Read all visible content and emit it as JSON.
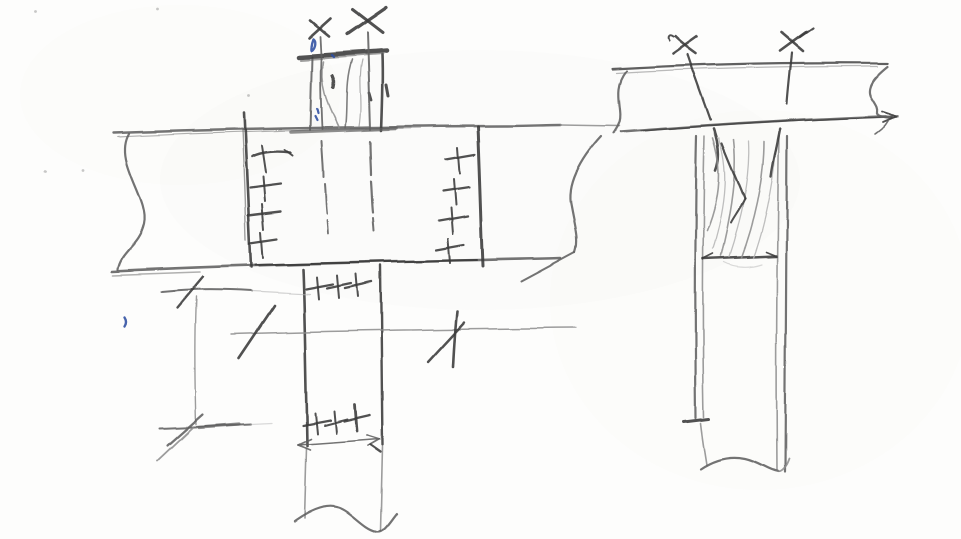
{
  "meta": {
    "kind": "hand-drawn pencil sketch",
    "subject": "timber beam-to-post connection details with screw markers, fastener crosses, wood grain and dimension ticks",
    "paper_color": "#fdfdfc"
  },
  "palette": {
    "k": "#3a3a3a",
    "m": "#606060",
    "l": "#8e8e8e",
    "f": "#b5b5b5",
    "b": "#2d4fa1"
  },
  "sketch": {
    "elements": [
      {
        "name": "left-beam",
        "label": "left detail continuous beam (side view) with break lines",
        "strokes": [
          {
            "d": "M114,133 C 230,129 400,126 505,126 C 525,126 548,125 561,125",
            "c": "m",
            "w": 2.4
          },
          {
            "d": "M118,137 C 200,133 300,130 420,128",
            "c": "l",
            "w": 1.2,
            "o": 0.7
          },
          {
            "d": "M561,125 L 619,126",
            "c": "l",
            "w": 1.4
          },
          {
            "d": "M112,271 C 220,266 360,262 480,260 C 510,259 540,259 561,258",
            "c": "m",
            "w": 2.6
          },
          {
            "d": "M255,265 C 330,263 410,261 477,260",
            "c": "k",
            "w": 2
          },
          {
            "d": "M113,275 L 200,272",
            "c": "l",
            "w": 1.6,
            "o": 0.7
          },
          {
            "d": "M129,134 C 113,162 150,198 144,224 C 139,246 121,251 118,269",
            "c": "m",
            "w": 2.2
          },
          {
            "d": "M601,136 C 579,160 566,186 571,206 C 575,228 579,240 575,252",
            "c": "m",
            "w": 2.2
          },
          {
            "d": "M575,252 L 521,281",
            "c": "m",
            "w": 2
          }
        ]
      },
      {
        "name": "left-joint-line-left",
        "label": "left vertical joint line of connection zone",
        "strokes": [
          {
            "d": "M244,113 C 246,160 248,210 251,267",
            "c": "k",
            "w": 2.6
          },
          {
            "d": "M242,130 C 244,170 245,205 246,240",
            "c": "m",
            "w": 1.4,
            "o": 0.6
          }
        ]
      },
      {
        "name": "left-joint-line-right",
        "label": "right vertical joint line of connection zone",
        "strokes": [
          {
            "d": "M478,127 C 480,170 481,215 483,266",
            "c": "k",
            "w": 3
          }
        ]
      },
      {
        "name": "fastener-column-left",
        "label": "column of 4 fastener cross marks",
        "strokes": [
          {
            "d": "M252,157 C 262,152 278,151 291,153",
            "c": "k",
            "w": 2.4
          },
          {
            "d": "M262,146 L 266,173",
            "c": "k",
            "w": 2
          },
          {
            "d": "M285,150 L 293,156",
            "c": "k",
            "w": 2
          },
          {
            "d": "M250,188 L 281,184",
            "c": "k",
            "w": 2.2
          },
          {
            "d": "M263,177 L 265,201",
            "c": "k",
            "w": 2
          },
          {
            "d": "M248,215 L 281,211",
            "c": "k",
            "w": 2.4
          },
          {
            "d": "M262,204 L 264,229",
            "c": "k",
            "w": 2
          },
          {
            "d": "M250,243 L 277,239",
            "c": "k",
            "w": 2.2
          },
          {
            "d": "M261,232 L 263,258",
            "c": "k",
            "w": 2
          }
        ]
      },
      {
        "name": "fastener-column-right",
        "label": "column of 4 fastener cross marks",
        "strokes": [
          {
            "d": "M446,159 L 475,154",
            "c": "k",
            "w": 2.4
          },
          {
            "d": "M458,147 L 460,173",
            "c": "k",
            "w": 2
          },
          {
            "d": "M443,191 L 470,187",
            "c": "k",
            "w": 2.2
          },
          {
            "d": "M454,179 L 456,205",
            "c": "k",
            "w": 2
          },
          {
            "d": "M439,221 L 468,216",
            "c": "k",
            "w": 2.4
          },
          {
            "d": "M451,208 L 453,234",
            "c": "k",
            "w": 2
          },
          {
            "d": "M436,250 L 464,245",
            "c": "k",
            "w": 2.2
          },
          {
            "d": "M448,239 L 450,263",
            "c": "k",
            "w": 2
          }
        ]
      },
      {
        "name": "top-post-stub",
        "label": "post stub above beam with cap plate and wood grain",
        "strokes": [
          {
            "d": "M312,57 L 310,130",
            "c": "m",
            "w": 2
          },
          {
            "d": "M382,55 C 383,80 382,105 381,130",
            "c": "k",
            "w": 2.6
          },
          {
            "d": "M299,57 L 387,51",
            "c": "k",
            "w": 4.5
          },
          {
            "d": "M301,60 L 383,54",
            "c": "m",
            "w": 2,
            "o": 0.6
          },
          {
            "d": "M292,132 L 396,128",
            "c": "m",
            "w": 3.5,
            "o": 0.7
          },
          {
            "d": "M323,62 C 318,88 330,108 339,128",
            "c": "l",
            "w": 1.6
          },
          {
            "d": "M352,60 C 344,84 348,108 345,128",
            "c": "m",
            "w": 1.6,
            "o": 0.8
          },
          {
            "d": "M362,60 C 357,80 363,102 359,126",
            "c": "l",
            "w": 1.2,
            "o": 0.7
          },
          {
            "d": "M332,76 C 334,80 334,84 333,88",
            "c": "k",
            "w": 3.2
          },
          {
            "d": "M369,93 L 371,100",
            "c": "k",
            "w": 2.8
          },
          {
            "d": "M386,85 L 388,96",
            "c": "k",
            "w": 3
          },
          {
            "d": "M320,37 L 321,56 M321,58 C 320,84 321,108 322,129",
            "c": "m",
            "w": 1.8
          },
          {
            "d": "M367,33 C 368,64 369,98 370,129",
            "c": "m",
            "w": 2
          }
        ]
      },
      {
        "name": "top-post-screw-x-marks",
        "label": "two X screw-head marks above stub",
        "strokes": [
          {
            "d": "M309,38 L 330,19",
            "c": "k",
            "w": 2.6
          },
          {
            "d": "M310,21 L 329,37",
            "c": "k",
            "w": 2.6
          },
          {
            "d": "M347,35 L 386,8",
            "c": "k",
            "w": 3.2
          },
          {
            "d": "M352,10 L 382,33",
            "c": "k",
            "w": 3
          }
        ]
      },
      {
        "name": "hidden-screw-lines",
        "label": "hidden screw shafts inside beam below stub",
        "strokes": [
          {
            "d": "M322,141 C 323,158 324,170 324,177",
            "c": "m",
            "w": 2
          },
          {
            "d": "M325,184 C 326,196 326,206 327,214",
            "c": "m",
            "w": 2
          },
          {
            "d": "M327,220 L 328,233",
            "c": "m",
            "w": 1.8
          },
          {
            "d": "M370,141 C 370,155 371,166 371,174",
            "c": "m",
            "w": 2.2
          },
          {
            "d": "M371,181 C 372,194 372,204 373,212",
            "c": "m",
            "w": 2.2
          },
          {
            "d": "M373,218 L 374,231",
            "c": "m",
            "w": 2
          }
        ]
      },
      {
        "name": "blue-ink-marks",
        "label": "small blue ballpoint dots and ticks",
        "strokes": [
          {
            "d": "M313,39 C 316,41 315,47 312,50 C 310,52 311,44 313,39",
            "c": "b",
            "w": 2.4
          },
          {
            "d": "M332,55 L 334,57",
            "c": "b",
            "w": 2.4
          },
          {
            "d": "M317,109 L 318,113",
            "c": "b",
            "w": 2.2
          },
          {
            "d": "M315,116 L 317,120",
            "c": "b",
            "w": 2.2
          },
          {
            "d": "M124,318 C 126,321 126,324 124,327",
            "c": "b",
            "w": 2.4
          }
        ]
      },
      {
        "name": "lower-post",
        "label": "post below beam continuing to break line",
        "strokes": [
          {
            "d": "M303,269 C 305,320 306,390 307,446",
            "c": "k",
            "w": 2.6
          },
          {
            "d": "M381,266 C 382,320 382,390 383,445",
            "c": "k",
            "w": 2.4
          },
          {
            "d": "M306,448 L 304,519",
            "c": "l",
            "w": 1.6
          },
          {
            "d": "M383,447 L 381,531",
            "c": "l",
            "w": 1.6
          },
          {
            "d": "M294,522 C 312,509 327,504 339,508 C 352,512 363,529 377,532 C 385,533 391,521 397,514",
            "c": "m",
            "w": 2.2
          }
        ]
      },
      {
        "name": "lower-post-fastener-row-top",
        "label": "row of 3 fastener crosses at post top",
        "strokes": [
          {
            "d": "M306,289 L 333,284",
            "c": "k",
            "w": 2.2
          },
          {
            "d": "M317,277 L 319,299",
            "c": "k",
            "w": 2
          },
          {
            "d": "M327,288 L 351,283",
            "c": "k",
            "w": 2.2
          },
          {
            "d": "M337,275 L 339,298",
            "c": "k",
            "w": 2
          },
          {
            "d": "M345,288 L 372,282",
            "c": "k",
            "w": 2.4
          },
          {
            "d": "M356,274 L 358,297",
            "c": "k",
            "w": 2
          }
        ]
      },
      {
        "name": "lower-post-fastener-row-bottom",
        "label": "row of 3 fastener crosses at post bottom",
        "strokes": [
          {
            "d": "M303,425 L 330,420",
            "c": "k",
            "w": 2.2
          },
          {
            "d": "M315,413 L 317,434",
            "c": "k",
            "w": 2
          },
          {
            "d": "M324,425 L 347,419",
            "c": "k",
            "w": 2
          },
          {
            "d": "M334,411 L 336,433",
            "c": "k",
            "w": 2
          },
          {
            "d": "M344,421 L 370,415",
            "c": "k",
            "w": 2.4
          },
          {
            "d": "M355,405 L 357,431",
            "c": "k",
            "w": 2.8
          }
        ]
      },
      {
        "name": "mid-dimension-line",
        "label": "horizontal reference line with oblique ticks",
        "strokes": [
          {
            "d": "M231,334 C 330,331 450,329 576,328",
            "c": "l",
            "w": 1.5
          },
          {
            "d": "M239,358 L 274,306",
            "c": "k",
            "w": 2.6
          },
          {
            "d": "M457,312 C 455,330 454,348 453,367",
            "c": "k",
            "w": 2.6
          },
          {
            "d": "M428,362 L 464,323",
            "c": "k",
            "w": 2.4
          }
        ]
      },
      {
        "name": "lower-post-dimension-arrow",
        "label": "width dimension arrow at post bottom",
        "strokes": [
          {
            "d": "M298,445 L 380,439",
            "c": "m",
            "w": 1.6
          },
          {
            "d": "M298,445 L 311,439",
            "c": "m",
            "w": 1.6
          },
          {
            "d": "M298,445 L 310,450",
            "c": "m",
            "w": 1.6
          },
          {
            "d": "M380,439 L 367,435",
            "c": "m",
            "w": 1.8
          },
          {
            "d": "M380,439 L 368,446",
            "c": "m",
            "w": 1.8
          },
          {
            "d": "M371,445 L 381,452",
            "c": "k",
            "w": 2.4
          }
        ]
      },
      {
        "name": "left-dimension-ticks",
        "label": "dimension lines with slash ticks lower left",
        "strokes": [
          {
            "d": "M161,292 C 190,289 220,289 251,291",
            "c": "m",
            "w": 2
          },
          {
            "d": "M251,291 L 310,294",
            "c": "f",
            "w": 1.2,
            "o": 0.6
          },
          {
            "d": "M177,308 L 203,277",
            "c": "k",
            "w": 2.4
          },
          {
            "d": "M196,297 C 194,340 195,390 196,425",
            "c": "l",
            "w": 1.4
          },
          {
            "d": "M160,429 L 251,425",
            "c": "m",
            "w": 2
          },
          {
            "d": "M199,428 L 239,425",
            "c": "m",
            "w": 3.2,
            "o": 0.7
          },
          {
            "d": "M168,446 L 203,415",
            "c": "m",
            "w": 2.2
          },
          {
            "d": "M158,461 L 193,428",
            "c": "l",
            "w": 1.8
          },
          {
            "d": "M251,425 L 272,424",
            "c": "f",
            "w": 1.2,
            "o": 0.5
          }
        ]
      },
      {
        "name": "right-beam",
        "label": "right detail beam with break lines both ends",
        "strokes": [
          {
            "d": "M612,69 C 700,64 800,62 888,63",
            "c": "k",
            "w": 2.2,
            "o": 0.8
          },
          {
            "d": "M616,73 C 700,68 790,66 878,66",
            "c": "l",
            "w": 1.2,
            "o": 0.6
          },
          {
            "d": "M620,132 C 700,126 800,119 898,116",
            "c": "m",
            "w": 2.6
          },
          {
            "d": "M640,131 C 730,124 820,119 893,117",
            "c": "k",
            "w": 1.6,
            "o": 0.7
          },
          {
            "d": "M626,71 C 611,90 623,108 619,122 C 617,128 615,130 613,133",
            "c": "m",
            "w": 2.2
          },
          {
            "d": "M888,66 C 873,78 866,88 871,97 C 875,104 878,107 877,112 C 876,116 883,117 891,118",
            "c": "m",
            "w": 2.2
          },
          {
            "d": "M897,116 L 882,111 M897,116 L 883,122",
            "c": "k",
            "w": 1.8
          },
          {
            "d": "M888,121 C 884,128 879,131 875,134",
            "c": "m",
            "w": 1.6
          }
        ]
      },
      {
        "name": "right-post",
        "label": "post under right beam with double edges, wood grain, notch line and break",
        "strokes": [
          {
            "d": "M697,136 C 695,220 695,320 696,418",
            "c": "m",
            "w": 2.2
          },
          {
            "d": "M705,136 C 703,220 702,320 704,417",
            "c": "l",
            "w": 1.6
          },
          {
            "d": "M779,136 C 777,230 776,340 777,470",
            "c": "l",
            "w": 1.6
          },
          {
            "d": "M787,136 C 786,230 785,340 785,472",
            "c": "m",
            "w": 2.2
          },
          {
            "d": "M703,259 L 776,256",
            "c": "k",
            "w": 2.6
          },
          {
            "d": "M703,259 L 713,254",
            "c": "k",
            "w": 1.6
          },
          {
            "d": "M776,256 L 766,252",
            "c": "k",
            "w": 1.6
          },
          {
            "d": "M684,422 L 709,419",
            "c": "k",
            "w": 3
          },
          {
            "d": "M701,423 C 703,440 705,452 707,465",
            "c": "l",
            "w": 1.6
          },
          {
            "d": "M701,469 C 716,459 731,456 746,459 C 760,462 768,470 779,472",
            "c": "m",
            "w": 2.2
          },
          {
            "d": "M779,472 C 785,470 787,464 789,459",
            "c": "l",
            "w": 1.8
          },
          {
            "d": "M714,129 C 719,143 721,157 716,170",
            "c": "k",
            "w": 2.6
          },
          {
            "d": "M713,138 C 721,162 723,192 707,231",
            "c": "l",
            "w": 1.6
          },
          {
            "d": "M719,138 C 729,168 727,202 713,249",
            "c": "f",
            "w": 1.3
          },
          {
            "d": "M734,139 C 738,172 731,216 721,256",
            "c": "l",
            "w": 1.6
          },
          {
            "d": "M749,141 C 751,177 741,221 729,257",
            "c": "f",
            "w": 1.3
          },
          {
            "d": "M764,141 C 764,182 753,226 741,258",
            "c": "l",
            "w": 1.6
          },
          {
            "d": "M776,147 C 773,187 763,231 753,258",
            "c": "f",
            "w": 1.3
          },
          {
            "d": "M724,262 C 735,268 750,268 762,264",
            "c": "f",
            "w": 1.2,
            "o": 0.5
          }
        ]
      },
      {
        "name": "right-screws",
        "label": "two X screw marks with inclined shafts into post",
        "strokes": [
          {
            "d": "M673,54 L 697,37",
            "c": "k",
            "w": 2.6
          },
          {
            "d": "M675,37 C 681,43 689,49 696,54",
            "c": "k",
            "w": 2.6
          },
          {
            "d": "M673,37 C 669,34 667,37 669,41",
            "c": "k",
            "w": 2
          },
          {
            "d": "M688,55 C 695,76 704,100 711,120",
            "c": "k",
            "w": 2.2
          },
          {
            "d": "M722,143 C 731,166 739,183 745,199",
            "c": "k",
            "w": 2.2
          },
          {
            "d": "M745,199 C 739,211 734,217 731,223",
            "c": "k",
            "w": 2
          },
          {
            "d": "M780,51 L 806,32",
            "c": "k",
            "w": 2.6
          },
          {
            "d": "M782,33 L 803,51",
            "c": "k",
            "w": 2.6
          },
          {
            "d": "M800,37 L 813,28",
            "c": "k",
            "w": 2.2
          },
          {
            "d": "M792,53 C 790,72 788,90 787,104",
            "c": "k",
            "w": 2.2
          },
          {
            "d": "M780,129 C 777,146 773,161 771,177",
            "c": "k",
            "w": 2.4
          }
        ]
      }
    ],
    "speckles": [
      [
        36,
        11
      ],
      [
        158,
        9
      ],
      [
        45,
        172
      ],
      [
        82,
        170
      ],
      [
        249,
        96
      ]
    ]
  }
}
